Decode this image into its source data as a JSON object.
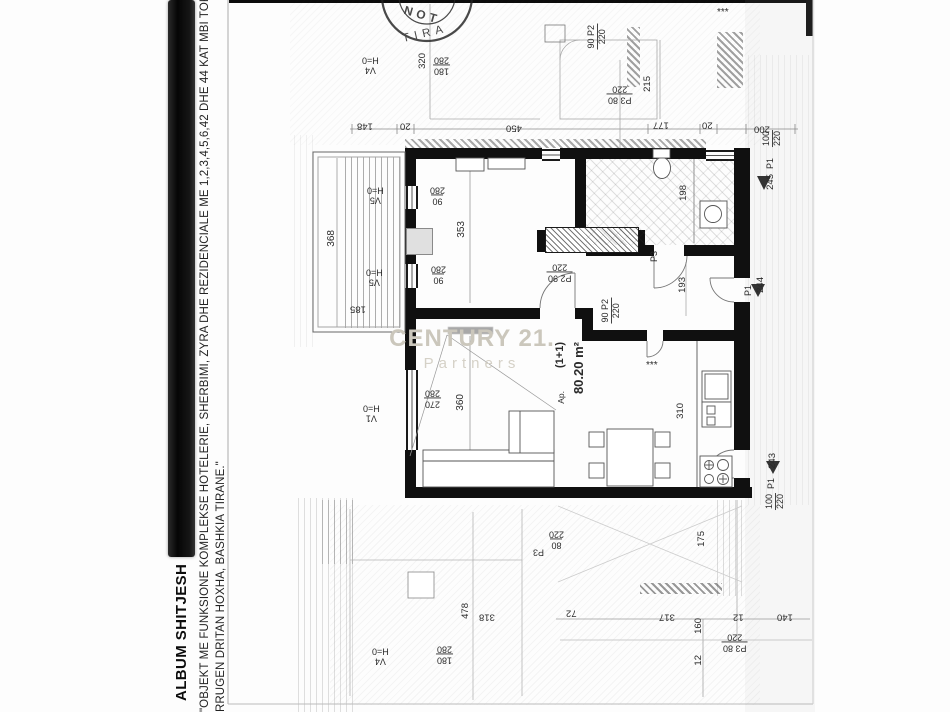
{
  "sidebar": {
    "title": "ALBUM SHITJESH",
    "quote_line1": "\"OBJEKT ME FUNKSIONE KOMPLEKSE HOTELERIE,  SHERBIMI, ZYRA  DHE REZIDENCIALE ME  1,2,3,4,5,6,42 DHE 44 KAT MBI TOKE DHE 5",
    "quote_line2": "RRUGEN DRITAN HOXHA, BASHKIA TIRANE.\""
  },
  "watermark": {
    "brand": "CENTURY 21.",
    "sub": "Partners",
    "color": "#cbc7bc"
  },
  "stamp": {
    "arc_top": "NOT",
    "arc_bottom": "TIRA"
  },
  "plan": {
    "unit_type": "(1+1)",
    "unit_area": "80.20 m²",
    "labels": [
      {
        "t": "V4\nH=0",
        "x": 361,
        "y": 55,
        "r": 180,
        "fs": 9
      },
      {
        "t": "320",
        "x": 418,
        "y": 52,
        "r": -90,
        "fs": 9.5
      },
      {
        "t": "180\n280",
        "x": 433,
        "y": 55,
        "r": 180,
        "fs": 9,
        "frac": true
      },
      {
        "t": "148",
        "x": 356,
        "y": 120,
        "r": 180,
        "fs": 9.5
      },
      {
        "t": "20",
        "x": 399,
        "y": 120,
        "r": 180,
        "fs": 9.5
      },
      {
        "t": "450",
        "x": 505,
        "y": 122,
        "r": 180,
        "fs": 9.5
      },
      {
        "t": "177",
        "x": 652,
        "y": 119,
        "r": 180,
        "fs": 9.5
      },
      {
        "t": "20",
        "x": 701,
        "y": 119,
        "r": 180,
        "fs": 9.5
      },
      {
        "t": "200",
        "x": 753,
        "y": 123,
        "r": 180,
        "fs": 9.5
      },
      {
        "t": "90  P2\n220",
        "x": 587,
        "y": 24,
        "r": -90,
        "fs": 9,
        "frac": true
      },
      {
        "t": "P3 80\n220",
        "x": 607,
        "y": 84,
        "r": 180,
        "fs": 9,
        "frac": true
      },
      {
        "t": "215",
        "x": 643,
        "y": 75,
        "r": -90,
        "fs": 9.5
      },
      {
        "t": "***",
        "x": 716,
        "y": 8,
        "r": 0,
        "fs": 10
      },
      {
        "t": "100\n220",
        "x": 762,
        "y": 130,
        "r": -90,
        "fs": 9,
        "frac": true
      },
      {
        "t": "P1",
        "x": 766,
        "y": 157,
        "r": -90,
        "fs": 9
      },
      {
        "t": "245",
        "x": 766,
        "y": 173,
        "r": -90,
        "fs": 9.5
      },
      {
        "t": "V5\nH=0",
        "x": 366,
        "y": 185,
        "r": 180,
        "fs": 9
      },
      {
        "t": "90\n280",
        "x": 429,
        "y": 185,
        "r": 180,
        "fs": 9,
        "frac": true
      },
      {
        "t": "V5\nH=0",
        "x": 365,
        "y": 267,
        "r": 180,
        "fs": 9
      },
      {
        "t": "90\n280",
        "x": 430,
        "y": 264,
        "r": 180,
        "fs": 9,
        "frac": true
      },
      {
        "t": "V1\nH=0",
        "x": 362,
        "y": 403,
        "r": 180,
        "fs": 9
      },
      {
        "t": "270\n280",
        "x": 424,
        "y": 388,
        "r": 180,
        "fs": 9,
        "frac": true
      },
      {
        "t": "368",
        "x": 327,
        "y": 229,
        "r": -90,
        "fs": 10
      },
      {
        "t": "185",
        "x": 349,
        "y": 303,
        "r": 180,
        "fs": 9.5
      },
      {
        "t": "353",
        "x": 457,
        "y": 220,
        "r": -90,
        "fs": 10
      },
      {
        "t": "360",
        "x": 456,
        "y": 393,
        "r": -90,
        "fs": 10
      },
      {
        "t": "P2 90\n220",
        "x": 547,
        "y": 262,
        "r": 180,
        "fs": 9,
        "frac": true
      },
      {
        "t": "90  P2\n220",
        "x": 601,
        "y": 298,
        "r": -90,
        "fs": 9,
        "frac": true
      },
      {
        "t": "P3",
        "x": 650,
        "y": 250,
        "r": -90,
        "fs": 9
      },
      {
        "t": "198",
        "x": 679,
        "y": 184,
        "r": -90,
        "fs": 9.5
      },
      {
        "t": "193",
        "x": 678,
        "y": 276,
        "r": -90,
        "fs": 9.5
      },
      {
        "t": "***",
        "x": 645,
        "y": 361,
        "r": 0,
        "fs": 10
      },
      {
        "t": "310",
        "x": 676,
        "y": 402,
        "r": -90,
        "fs": 9.5
      },
      {
        "t": "Ap.",
        "x": 557,
        "y": 390,
        "r": -90,
        "fs": 8.5
      },
      {
        "t": "(1+1)",
        "x": 555,
        "y": 341,
        "r": -90,
        "fs": 11,
        "b": true
      },
      {
        "t": "80.20 m²",
        "x": 572,
        "y": 341,
        "r": -90,
        "fs": 13,
        "b": true
      },
      {
        "t": "244",
        "x": 756,
        "y": 276,
        "r": -90,
        "fs": 9.5
      },
      {
        "t": "P1",
        "x": 744,
        "y": 284,
        "r": -90,
        "fs": 9
      },
      {
        "t": "243",
        "x": 768,
        "y": 452,
        "r": -90,
        "fs": 9.5
      },
      {
        "t": "P1",
        "x": 767,
        "y": 477,
        "r": -90,
        "fs": 9
      },
      {
        "t": "100\n220",
        "x": 765,
        "y": 493,
        "r": -90,
        "fs": 9,
        "frac": true
      },
      {
        "t": "80\n220",
        "x": 548,
        "y": 529,
        "r": 180,
        "fs": 9,
        "frac": true
      },
      {
        "t": "P3",
        "x": 532,
        "y": 547,
        "r": 180,
        "fs": 9
      },
      {
        "t": "175",
        "x": 697,
        "y": 530,
        "r": -90,
        "fs": 9.5
      },
      {
        "t": "72",
        "x": 565,
        "y": 607,
        "r": 180,
        "fs": 9.5
      },
      {
        "t": "317",
        "x": 658,
        "y": 611,
        "r": 180,
        "fs": 9.5
      },
      {
        "t": "12",
        "x": 732,
        "y": 611,
        "r": 180,
        "fs": 9.5
      },
      {
        "t": "140",
        "x": 776,
        "y": 611,
        "r": 180,
        "fs": 9.5
      },
      {
        "t": "160",
        "x": 694,
        "y": 617,
        "r": -90,
        "fs": 9.5
      },
      {
        "t": "12",
        "x": 694,
        "y": 654,
        "r": -90,
        "fs": 9.5
      },
      {
        "t": "P3 80\n220",
        "x": 722,
        "y": 632,
        "r": 180,
        "fs": 9,
        "frac": true
      },
      {
        "t": "478",
        "x": 461,
        "y": 602,
        "r": -90,
        "fs": 9.5
      },
      {
        "t": "318",
        "x": 478,
        "y": 611,
        "r": 180,
        "fs": 9.5
      },
      {
        "t": "180\n280",
        "x": 436,
        "y": 644,
        "r": 180,
        "fs": 9,
        "frac": true
      },
      {
        "t": "V4\nH=0",
        "x": 371,
        "y": 646,
        "r": 180,
        "fs": 9
      }
    ]
  }
}
